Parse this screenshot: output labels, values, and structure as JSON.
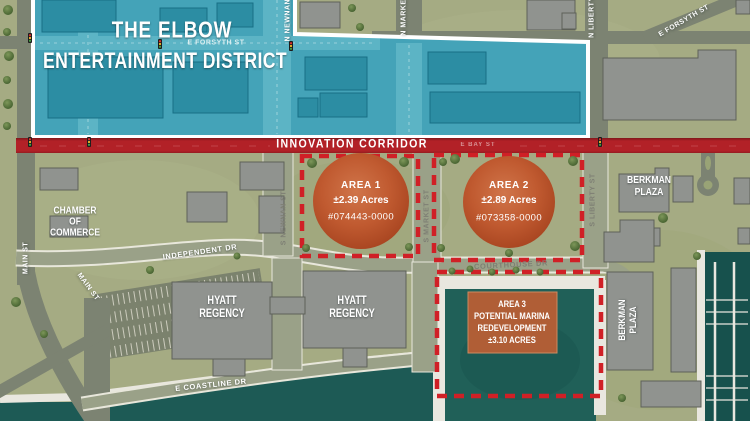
{
  "district": {
    "title_line1": "THE ELBOW",
    "title_line2": "ENTERTAINMENT DISTRICT"
  },
  "corridor": {
    "label": "INNOVATION CORRIDOR"
  },
  "parcels": {
    "area1": {
      "name": "AREA 1",
      "size": "±2.39 Acres",
      "parcel_id": "#074443-0000"
    },
    "area2": {
      "name": "AREA 2",
      "size": "±2.89 Acres",
      "parcel_id": "#073358-0000"
    },
    "area3": {
      "name": "AREA 3",
      "line2": "POTENTIAL MARINA",
      "line3": "REDEVELOPMENT",
      "line4": "±3.10 ACRES"
    }
  },
  "places": {
    "chamber_line1": "CHAMBER",
    "chamber_line2": "OF",
    "chamber_line3": "COMMERCE",
    "hyatt_line1": "HYATT",
    "hyatt_line2": "REGENCY",
    "berkman_line1": "BERKMAN",
    "berkman_line2": "PLAZA"
  },
  "streets": {
    "e_forsyth": "E FORSYTH ST",
    "n_newnan": "N NEWNAN ST",
    "n_market": "N MARKET ST",
    "n_liberty": "N LIBERTY ST",
    "main": "MAIN ST",
    "independent": "INDEPENDENT DR",
    "s_newnan": "S NEWNAN ST",
    "s_market": "S MARKET ST",
    "s_liberty": "S LIBERTY ST",
    "courthouse": "COURTHOUSE DR",
    "e_coastline": "E COASTLINE DR",
    "e_bay": "E BAY ST"
  },
  "colors": {
    "district_teal": "#44a3b8",
    "corridor_red": "#b22127",
    "parcel_dash_red": "#d02026",
    "area_circle_orange": "#bf5930",
    "water": "#1d5a55",
    "land_green": "#a5ab83",
    "building_gray": "#90938f"
  }
}
